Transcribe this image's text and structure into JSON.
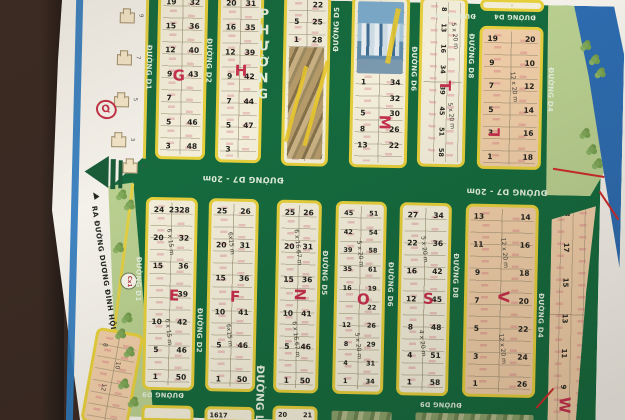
{
  "palette": {
    "table_brown": "#3a2a23",
    "paper_white": "#f4f1ea",
    "stripe_blue": "#2f7abc",
    "map_green": "#156a3e",
    "block_border_yellow": "#e6cf3c",
    "block_cream": "#f3eeda",
    "block_salmon": "#efcda8",
    "park_green": "#b9cf90",
    "river_blue": "#2d6cb0",
    "letter_red": "#c5304c",
    "shore_red": "#cc2b2b"
  },
  "streets": {
    "d1": "ĐƯỜNG D1",
    "d2": "ĐƯỜNG D2",
    "d4": "ĐƯỜNG D4",
    "d5": "ĐƯỜNG D5",
    "d6": "ĐƯỜNG D6",
    "d7": "ĐƯỜNG D7 - 20m",
    "d8": "ĐƯỜNG D8",
    "d9": "ĐƯỜNG D9",
    "lien_phuong_top": "PHƯỜNG",
    "lien_phuong_bottom": "ĐƯỜNG LIÊ",
    "exit_road": "RA ĐƯỜNG DƯƠNG ĐÌNH HỘI"
  },
  "landmarks": {
    "cx1": "Cx1"
  },
  "blocks": {
    "q": {
      "letter": "Q",
      "houses": [
        "1",
        "3",
        "5",
        "7",
        "9"
      ]
    },
    "g": {
      "letter": "G",
      "rows": [
        [
          "19",
          "32"
        ],
        [
          "15",
          "36"
        ],
        [
          "12",
          "40"
        ],
        [
          "9",
          "43"
        ],
        [
          "7",
          ""
        ],
        [
          "5",
          "46"
        ],
        [
          "3",
          "48"
        ]
      ]
    },
    "h": {
      "letter": "H",
      "rows": [
        [
          "20",
          "31"
        ],
        [
          "16",
          "35"
        ],
        [
          "12",
          "39"
        ],
        [
          "9",
          "42"
        ],
        [
          "7",
          "44"
        ],
        [
          "5",
          "47"
        ],
        [
          "3",
          ""
        ]
      ]
    },
    "photo_block": {
      "rows": [
        [
          "",
          "22"
        ],
        [
          "5",
          "25"
        ],
        [
          "1",
          "28"
        ]
      ]
    },
    "m": {
      "letter": "M",
      "rows": [
        [
          "1",
          "34"
        ],
        [
          "",
          "32"
        ],
        [
          "5",
          "30"
        ],
        [
          "8",
          "26"
        ],
        [
          "13",
          "22"
        ]
      ]
    },
    "t": {
      "letter": "T",
      "dim": "5 x 20 m",
      "nums": [
        "8",
        "13",
        "16",
        "34",
        "39",
        "45",
        "51",
        "58"
      ]
    },
    "l": {
      "letter": "L",
      "dim": "12 x 20 m",
      "rows": [
        [
          "19",
          "20"
        ],
        [
          "9",
          "10"
        ],
        [
          "7",
          "12"
        ],
        [
          "5",
          "14"
        ],
        [
          "3",
          "16"
        ],
        [
          "1",
          "18"
        ]
      ]
    },
    "e": {
      "letter": "E",
      "dim": "6 x 15 m",
      "rows": [
        [
          "24",
          "2328"
        ],
        [
          "20",
          "32"
        ],
        [
          "15",
          "36"
        ],
        [
          "",
          "39"
        ],
        [
          "10",
          "42"
        ],
        [
          "5",
          "46"
        ],
        [
          "1",
          "50"
        ]
      ]
    },
    "f": {
      "letter": "F",
      "dim": "6x15 m",
      "rows": [
        [
          "25",
          "26"
        ],
        [
          "20",
          "31"
        ],
        [
          "15",
          "36"
        ],
        [
          "10",
          "41"
        ],
        [
          "5",
          "46"
        ],
        [
          "1",
          "50"
        ]
      ]
    },
    "n": {
      "letter": "N",
      "dim": "6 x 16.67 m",
      "rows": [
        [
          "25",
          "26"
        ],
        [
          "20",
          "31"
        ],
        [
          "15",
          "36"
        ],
        [
          "10",
          "41"
        ],
        [
          "5",
          "46"
        ],
        [
          "1",
          "50"
        ]
      ]
    },
    "o": {
      "letter": "O",
      "dim": "5 x 20 m",
      "rows": [
        [
          "45",
          "51"
        ],
        [
          "42",
          "54"
        ],
        [
          "39",
          "58"
        ],
        [
          "35",
          "61"
        ],
        [
          "16",
          "19"
        ],
        [
          "",
          "22"
        ],
        [
          "12",
          "26"
        ],
        [
          "8",
          "29"
        ],
        [
          "4",
          "31"
        ],
        [
          "1",
          "34"
        ]
      ]
    },
    "s": {
      "letter": "S",
      "dim_a": "5 x 20 m",
      "dim_b": "4 x 20 m",
      "rows": [
        [
          "27",
          "34"
        ],
        [
          "22",
          "36"
        ],
        [
          "16",
          "42"
        ],
        [
          "12",
          "45"
        ],
        [
          "8",
          "48"
        ],
        [
          "4",
          "51"
        ],
        [
          "1",
          "58"
        ]
      ]
    },
    "v": {
      "letter": "V",
      "dim": "12 x 20 m",
      "rows": [
        [
          "13",
          "14"
        ],
        [
          "11",
          "16"
        ],
        [
          "9",
          "18"
        ],
        [
          "7",
          "20"
        ],
        [
          "5",
          "22"
        ],
        [
          "3",
          "24"
        ],
        [
          "1",
          "26"
        ]
      ]
    },
    "w": {
      "letter": "W",
      "lots": [
        "18",
        "17",
        "15",
        "13",
        "11",
        "9"
      ]
    },
    "corner": {
      "nums": [
        "8",
        "10",
        "12"
      ]
    },
    "bottom_row": {
      "n_left": "20",
      "n_right": "21",
      "f_text": "1617"
    }
  }
}
